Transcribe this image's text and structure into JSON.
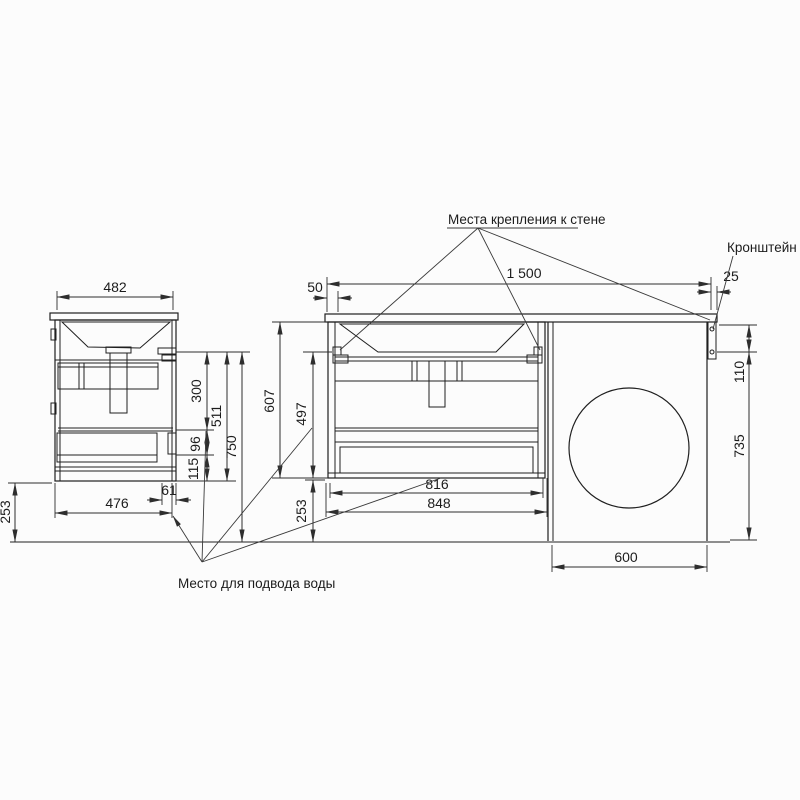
{
  "colors": {
    "background": "#fcfcfc",
    "line": "#1f1f1f",
    "dimension": "#2e2e2e",
    "text": "#1c1c1c"
  },
  "callouts": {
    "wall_mount": "Места крепления к стене",
    "bracket": "Кронштейн",
    "water_supply": "Место для подвода воды"
  },
  "side_view": {
    "top_width": "482",
    "upper_height": "300",
    "body_height": "511",
    "mount_to_floor": "750",
    "recess_height": "96",
    "recess_bottom": "115",
    "recess_width": "61",
    "bottom_depth": "476",
    "floor_gap": "253"
  },
  "front_view": {
    "countertop_width": "1 500",
    "left_offset": "50",
    "bracket_offset": "25",
    "total_height": "607",
    "body_height": "497",
    "drawer_width": "816",
    "body_width": "848",
    "floor_gap": "253"
  },
  "washer_bay": {
    "bracket_drop": "110",
    "bay_height": "735",
    "bay_width": "600"
  }
}
